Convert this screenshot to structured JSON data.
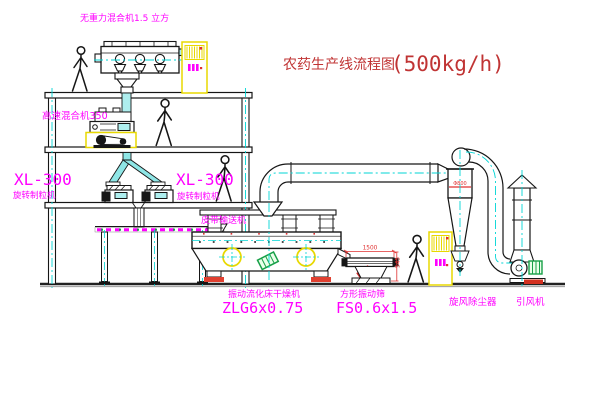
{
  "title": {
    "text": "农药生产线流程图",
    "capacity": "(500kg/h)"
  },
  "equipment": {
    "gravity_mixer": {
      "label": "无重力混合机1.5 立方"
    },
    "high_speed_mixer": {
      "label": "高速混合机350"
    },
    "granulator_left": {
      "model": "XL-300",
      "name": "旋转制粒机"
    },
    "granulator_right": {
      "model": "XL-300",
      "name": "旋转制粒机"
    },
    "belt_conveyor": {
      "name": "皮带输送机"
    },
    "dryer": {
      "name": "振动流化床干燥机",
      "model": "ZLG6x0.75"
    },
    "screen": {
      "name": "方形振动筛",
      "model": "FS0.6x1.5",
      "dim_length": "1500",
      "dim_height": "545"
    },
    "cyclone": {
      "name": "旋风除尘器",
      "dim_diameter": "Φ800"
    },
    "fan": {
      "name": "引风机"
    }
  },
  "colors": {
    "label_magenta": "#ff00ff",
    "title_red": "#c03434",
    "centerline_cyan": "#00d5d5",
    "cabinet_yellow": "#e8d800",
    "dimension_red": "#e03030",
    "motor_green": "#18a048",
    "line_black": "#161616",
    "pipe_fill_cyan": "#aeeeee",
    "background": "#ffffff"
  }
}
